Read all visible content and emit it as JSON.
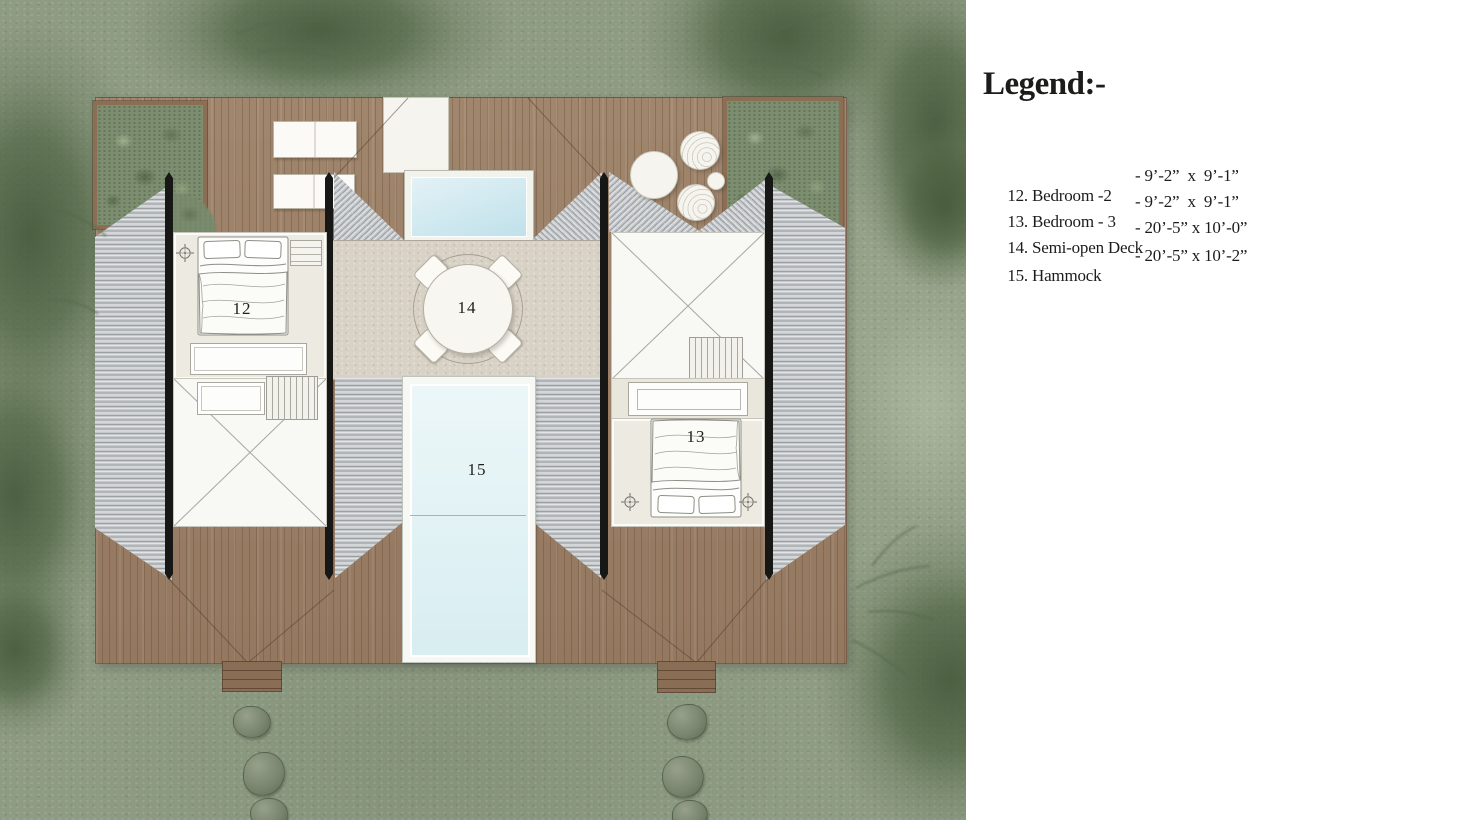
{
  "plan": {
    "labels": {
      "bedroom2": "12",
      "bedroom3": "13",
      "semiOpenDeck": "14",
      "hammock": "15"
    }
  },
  "legend": {
    "title": "Legend:-",
    "items": [
      {
        "label": "12. Bedroom -2",
        "dims": "- 9’-2”  x  9’-1”"
      },
      {
        "label": "13. Bedroom - 3",
        "dims": "- 9’-2”  x  9’-1”"
      },
      {
        "label": "14. Semi-open Deck",
        "dims": "- 20’-5” x 10’-0”"
      },
      {
        "label": "15. Hammock",
        "dims": "- 20’-5” x 10’-2”"
      }
    ]
  },
  "colors": {
    "grass": "#8f9c84",
    "palm": "#64775a",
    "deck_wood": "#9c7f66",
    "roof_gray": "#c6c9cb",
    "stone_floor": "#d8d1c5",
    "pool_water": "#cbe7ef",
    "hammock_net": "#dff1f4",
    "ridge_black": "#171715",
    "legend_text": "#1c1c1a",
    "panel_bg": "#ffffff"
  }
}
